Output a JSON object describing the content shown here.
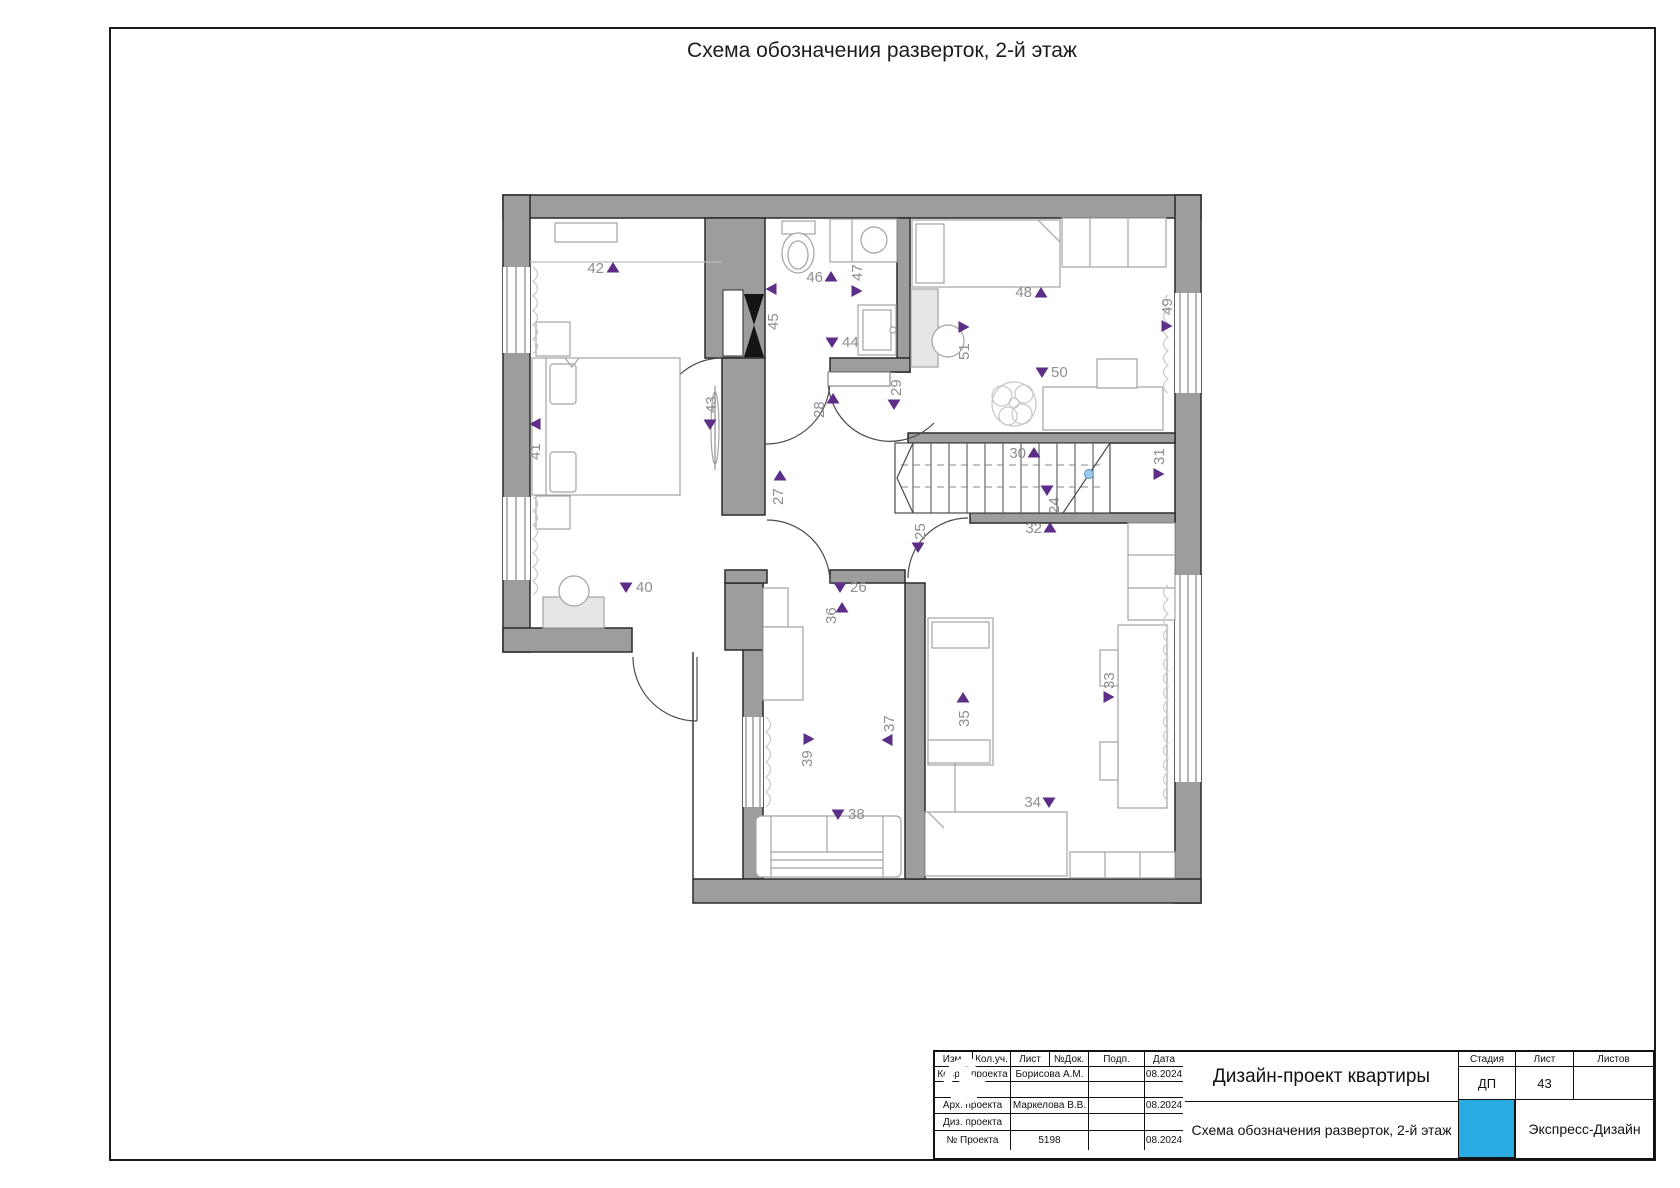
{
  "sheet": {
    "title": "Схема обозначения разверток, 2-й этаж"
  },
  "plan": {
    "marker_color": "#5c2e87",
    "label_color": "#8e8e8e",
    "stair_dot": {
      "x": 1089,
      "y": 474,
      "fill": "#9fc9ea",
      "stroke": "#4a90c4"
    },
    "markers": [
      {
        "n": "24",
        "dir": "down",
        "x": 1047,
        "y": 490,
        "lx": 1059,
        "ly": 514,
        "rot": true,
        "anchor": "start"
      },
      {
        "n": "25",
        "dir": "down",
        "x": 918,
        "y": 547,
        "lx": 925,
        "ly": 540,
        "rot": true,
        "anchor": "start"
      },
      {
        "n": "26",
        "dir": "down",
        "x": 840,
        "y": 587,
        "lx": 850,
        "ly": 592,
        "rot": false,
        "anchor": "start"
      },
      {
        "n": "27",
        "dir": "up",
        "x": 780,
        "y": 476,
        "lx": 783,
        "ly": 505,
        "rot": true,
        "anchor": "start"
      },
      {
        "n": "28",
        "dir": "up",
        "x": 833,
        "y": 399,
        "lx": 824,
        "ly": 418,
        "rot": true,
        "anchor": "start"
      },
      {
        "n": "29",
        "dir": "down",
        "x": 894,
        "y": 404,
        "lx": 901,
        "ly": 396,
        "rot": true,
        "anchor": "start"
      },
      {
        "n": "30",
        "dir": "up",
        "x": 1034,
        "y": 453,
        "lx": 1026,
        "ly": 458,
        "rot": false,
        "anchor": "end"
      },
      {
        "n": "31",
        "dir": "right",
        "x": 1158,
        "y": 474,
        "lx": 1164,
        "ly": 465,
        "rot": true,
        "anchor": "start"
      },
      {
        "n": "32",
        "dir": "up",
        "x": 1050,
        "y": 528,
        "lx": 1042,
        "ly": 533,
        "rot": false,
        "anchor": "end"
      },
      {
        "n": "33",
        "dir": "right",
        "x": 1108,
        "y": 697,
        "lx": 1114,
        "ly": 689,
        "rot": true,
        "anchor": "start"
      },
      {
        "n": "34",
        "dir": "down",
        "x": 1049,
        "y": 802,
        "lx": 1041,
        "ly": 807,
        "rot": false,
        "anchor": "end"
      },
      {
        "n": "35",
        "dir": "up",
        "x": 963,
        "y": 698,
        "lx": 969,
        "ly": 727,
        "rot": true,
        "anchor": "start"
      },
      {
        "n": "36",
        "dir": "up",
        "x": 842,
        "y": 608,
        "lx": 836,
        "ly": 624,
        "rot": true,
        "anchor": "start"
      },
      {
        "n": "37",
        "dir": "left",
        "x": 888,
        "y": 740,
        "lx": 894,
        "ly": 732,
        "rot": true,
        "anchor": "start"
      },
      {
        "n": "38",
        "dir": "down",
        "x": 838,
        "y": 814,
        "lx": 848,
        "ly": 819,
        "rot": false,
        "anchor": "start"
      },
      {
        "n": "39",
        "dir": "right",
        "x": 808,
        "y": 739,
        "lx": 812,
        "ly": 767,
        "rot": true,
        "anchor": "start"
      },
      {
        "n": "40",
        "dir": "down",
        "x": 626,
        "y": 587,
        "lx": 636,
        "ly": 592,
        "rot": false,
        "anchor": "start"
      },
      {
        "n": "41",
        "dir": "left",
        "x": 536,
        "y": 424,
        "lx": 540,
        "ly": 460,
        "rot": true,
        "anchor": "start"
      },
      {
        "n": "42",
        "dir": "up",
        "x": 613,
        "y": 268,
        "lx": 604,
        "ly": 273,
        "rot": false,
        "anchor": "end"
      },
      {
        "n": "43",
        "dir": "down",
        "x": 710,
        "y": 424,
        "lx": 716,
        "ly": 413,
        "rot": true,
        "anchor": "start"
      },
      {
        "n": "44",
        "dir": "down",
        "x": 832,
        "y": 342,
        "lx": 842,
        "ly": 347,
        "rot": false,
        "anchor": "start"
      },
      {
        "n": "45",
        "dir": "left",
        "x": 772,
        "y": 289,
        "lx": 778,
        "ly": 330,
        "rot": true,
        "anchor": "start"
      },
      {
        "n": "46",
        "dir": "up",
        "x": 831,
        "y": 277,
        "lx": 823,
        "ly": 282,
        "rot": false,
        "anchor": "end"
      },
      {
        "n": "47",
        "dir": "right",
        "x": 856,
        "y": 291,
        "lx": 862,
        "ly": 281,
        "rot": true,
        "anchor": "start"
      },
      {
        "n": "48",
        "dir": "up",
        "x": 1041,
        "y": 293,
        "lx": 1032,
        "ly": 297,
        "rot": false,
        "anchor": "end"
      },
      {
        "n": "49",
        "dir": "right",
        "x": 1166,
        "y": 326,
        "lx": 1172,
        "ly": 315,
        "rot": true,
        "anchor": "start"
      },
      {
        "n": "50",
        "dir": "down",
        "x": 1042,
        "y": 372,
        "lx": 1051,
        "ly": 377,
        "rot": false,
        "anchor": "start"
      },
      {
        "n": "51",
        "dir": "right",
        "x": 963,
        "y": 327,
        "lx": 969,
        "ly": 360,
        "rot": true,
        "anchor": "start"
      }
    ]
  },
  "title_block": {
    "columns": [
      "Изм.",
      "Кол.уч.",
      "Лист",
      "№Док.",
      "Подп.",
      "Дата"
    ],
    "rows": [
      {
        "label": "Коорд. проекта",
        "value": "Борисова А.М.",
        "sign": "",
        "date": "08.2024"
      },
      {
        "label": "",
        "value": "",
        "sign": "",
        "date": ""
      },
      {
        "label": "Арх. проекта",
        "value": "Маркелова В.В.",
        "sign": "",
        "date": "08.2024"
      },
      {
        "label": "Диз. проекта",
        "value": "",
        "sign": "",
        "date": ""
      },
      {
        "label": "№ Проекта",
        "value": "5198",
        "sign": "",
        "date": "08.2024"
      }
    ],
    "project_title": "Дизайн-проект квартиры",
    "drawing_title": "Схема обозначения разверток, 2-й этаж",
    "stage_label": "Стадия",
    "sheet_label": "Лист",
    "sheets_label": "Листов",
    "stage": "ДП",
    "sheet_no": "43",
    "sheets_total": "",
    "company": "Экспресс-Дизайн",
    "logo_color": "#29abe2"
  }
}
